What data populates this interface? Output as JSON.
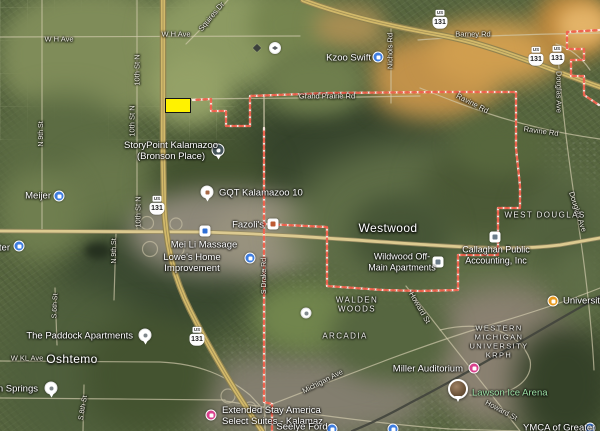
{
  "map": {
    "colors": {
      "boundary": "#EE604B",
      "parcel_fill": "#FFF200",
      "poi_blue": "#3E7DE0",
      "poi_pink": "#D9418D",
      "poi_orange": "#E89A1F",
      "park_text": "#9FE3A8",
      "freeway": "#D2B96A",
      "major_road": "#DCCA90"
    },
    "parcel": {
      "x": 165,
      "y": 98,
      "w": 26,
      "h": 15
    },
    "labels": [
      {
        "n": "road-w-h-ave-1",
        "t": "W H Ave",
        "x": 59,
        "y": 40,
        "fs": 7.5,
        "cls": "road"
      },
      {
        "n": "road-w-h-ave-2",
        "t": "W H Ave",
        "x": 176,
        "y": 35,
        "fs": 7.5,
        "cls": "road"
      },
      {
        "n": "road-squires-dr",
        "t": "Squires Dr",
        "x": 212,
        "y": 17,
        "fs": 7.5,
        "cls": "road",
        "rot": -50
      },
      {
        "n": "road-10th-st-n-1",
        "t": "10th St N",
        "x": 138,
        "y": 70,
        "fs": 7.5,
        "cls": "road",
        "rot": -90
      },
      {
        "n": "road-10th-st-n-2",
        "t": "10th St N",
        "x": 133,
        "y": 121,
        "fs": 7.5,
        "cls": "road",
        "rot": -90
      },
      {
        "n": "road-10th-st-n-3",
        "t": "10th St N",
        "x": 139,
        "y": 212,
        "fs": 7.5,
        "cls": "road",
        "rot": -90
      },
      {
        "n": "road-n-9th-st-1",
        "t": "N 9th St",
        "x": 42,
        "y": 134,
        "fs": 7,
        "cls": "road",
        "rot": -90
      },
      {
        "n": "road-n-9th-st-2",
        "t": "N 9th St",
        "x": 115,
        "y": 251,
        "fs": 7,
        "cls": "road",
        "rot": -90
      },
      {
        "n": "road-s-6th-st",
        "t": "S 6th St",
        "x": 56,
        "y": 306,
        "fs": 7,
        "cls": "road",
        "rot": -87
      },
      {
        "n": "road-s-8th-st",
        "t": "S 8th St",
        "x": 84,
        "y": 408,
        "fs": 7,
        "cls": "road",
        "rot": -80
      },
      {
        "n": "road-w-kl-ave",
        "t": "W KL Ave",
        "x": 27,
        "y": 359,
        "fs": 7.5,
        "cls": "road"
      },
      {
        "n": "road-grand-prairie-rd",
        "t": "Grand Prairie Rd",
        "x": 327,
        "y": 97,
        "fs": 7.5,
        "cls": "road"
      },
      {
        "n": "road-barney-rd",
        "t": "Barney Rd",
        "x": 473,
        "y": 35,
        "fs": 7.5,
        "cls": "road"
      },
      {
        "n": "road-ravine-rd-1",
        "t": "Ravine Rd",
        "x": 472,
        "y": 104,
        "fs": 7.5,
        "cls": "road",
        "rot": 27
      },
      {
        "n": "road-ravine-rd-2",
        "t": "Ravine Rd",
        "x": 541,
        "y": 132,
        "fs": 7.5,
        "cls": "road",
        "rot": 8
      },
      {
        "n": "road-nichols-rd",
        "t": "Nichols Rd",
        "x": 391,
        "y": 51,
        "fs": 7.5,
        "cls": "road",
        "rot": -90
      },
      {
        "n": "road-douglas-ave-1",
        "t": "Douglas Ave",
        "x": 558,
        "y": 92,
        "fs": 7.5,
        "cls": "road",
        "rot": 90
      },
      {
        "n": "road-douglas-ave-2",
        "t": "Douglas Ave",
        "x": 577,
        "y": 212,
        "fs": 7.5,
        "cls": "road",
        "rot": 72
      },
      {
        "n": "road-howard-st-1",
        "t": "Howard St",
        "x": 419,
        "y": 308,
        "fs": 7.5,
        "cls": "road",
        "rot": 60
      },
      {
        "n": "road-howard-st-2",
        "t": "Howard St",
        "x": 501,
        "y": 411,
        "fs": 7.5,
        "cls": "road",
        "rot": 28
      },
      {
        "n": "road-michigan-ave",
        "t": "Michigan Ave",
        "x": 323,
        "y": 382,
        "fs": 7.5,
        "cls": "road",
        "rot": -27
      },
      {
        "n": "road-s-drake-rd",
        "t": "S Drake Rd",
        "x": 265,
        "y": 276,
        "fs": 7,
        "cls": "road",
        "rot": -90
      },
      {
        "n": "place-oshtemo",
        "t": "Oshtemo",
        "x": 72,
        "y": 359,
        "fs": 12,
        "cls": "place"
      },
      {
        "n": "place-westwood",
        "t": "Westwood",
        "x": 388,
        "y": 228,
        "fs": 12,
        "cls": "place"
      },
      {
        "n": "hood-walden-woods",
        "t": "WALDEN\nWOODS",
        "x": 357,
        "y": 305,
        "fs": 8,
        "cls": "hood"
      },
      {
        "n": "hood-arcadia",
        "t": "ARCADIA",
        "x": 345,
        "y": 336,
        "fs": 8,
        "cls": "hood"
      },
      {
        "n": "hood-west-douglas",
        "t": "WEST DOUGLAS",
        "x": 545,
        "y": 215,
        "fs": 8,
        "cls": "hood"
      },
      {
        "n": "hood-western-michigan-university",
        "t": "WESTERN\nMICHIGAN\nUNIVERSITY\nKRPH",
        "x": 499,
        "y": 342,
        "fs": 7.5,
        "cls": "hood"
      },
      {
        "n": "poi-storypoint-kalamazoo",
        "t": "StoryPoint Kalamazoo\n(Bronson Place)",
        "x": 171,
        "y": 151,
        "fs": 9.5,
        "cls": "poi"
      },
      {
        "n": "poi-kzoo-swift",
        "t": "Kzoo Swift",
        "x": 371,
        "y": 58,
        "fs": 9.5,
        "cls": "poi",
        "a": "r"
      },
      {
        "n": "poi-meijer",
        "t": "Meijer",
        "x": 51,
        "y": 196,
        "fs": 9.5,
        "cls": "poi",
        "a": "r"
      },
      {
        "n": "poi-left-edge-cut",
        "t": "ter",
        "x": 10,
        "y": 248,
        "fs": 9.5,
        "cls": "poi",
        "a": "r"
      },
      {
        "n": "poi-gqt-kalamazoo-10",
        "t": "GQT Kalamazoo 10",
        "x": 219,
        "y": 193,
        "fs": 9.5,
        "cls": "poi",
        "a": "l"
      },
      {
        "n": "poi-mei-li-massage",
        "t": "Mei Li Massage",
        "x": 204,
        "y": 245,
        "fs": 9.5,
        "cls": "poi"
      },
      {
        "n": "poi-fazolis",
        "t": "Fazoli's",
        "x": 264,
        "y": 225,
        "fs": 9.5,
        "cls": "poi",
        "a": "r"
      },
      {
        "n": "poi-lowes-home-improvement",
        "t": "Lowe's Home\nImprovement",
        "x": 192,
        "y": 263,
        "fs": 9.5,
        "cls": "poi"
      },
      {
        "n": "poi-wildwood-off-main",
        "t": "Wildwood Off-\nMain Apartments",
        "x": 402,
        "y": 262,
        "fs": 9,
        "cls": "poi"
      },
      {
        "n": "poi-callaghan-accounting",
        "t": "Callaghan Public\nAccounting, Inc",
        "x": 496,
        "y": 255,
        "fs": 9,
        "cls": "poi"
      },
      {
        "n": "poi-paddock-apartments",
        "t": "The Paddock Apartments",
        "x": 133,
        "y": 336,
        "fs": 9.5,
        "cls": "poi",
        "a": "r"
      },
      {
        "n": "poi-tain-springs-cut",
        "t": "tain Springs",
        "x": 38,
        "y": 389,
        "fs": 9.5,
        "cls": "poi",
        "a": "r"
      },
      {
        "n": "poi-miller-auditorium",
        "t": "Miller Auditorium",
        "x": 463,
        "y": 369,
        "fs": 9.5,
        "cls": "poi",
        "a": "r"
      },
      {
        "n": "poi-lawson-ice-arena",
        "t": "Lawson Ice Arena",
        "x": 472,
        "y": 393,
        "fs": 9.5,
        "cls": "park",
        "a": "l"
      },
      {
        "n": "poi-university-cut",
        "t": "University Ro",
        "x": 563,
        "y": 301,
        "fs": 9.5,
        "cls": "poi",
        "a": "l"
      },
      {
        "n": "poi-extended-stay-america",
        "t": "Extended Stay America\nSelect Suites - Kalamaz",
        "x": 222,
        "y": 416,
        "fs": 9.5,
        "cls": "poi",
        "a": "l"
      },
      {
        "n": "poi-seelye-ford",
        "t": "Seelye Ford",
        "x": 302,
        "y": 427,
        "fs": 9.5,
        "cls": "poi"
      },
      {
        "n": "poi-ymca",
        "t": "YMCA of Greater",
        "x": 523,
        "y": 428,
        "fs": 9.5,
        "cls": "poi",
        "a": "l"
      }
    ],
    "icons": [
      {
        "k": "pin-dark",
        "x": 218,
        "y": 150,
        "n": "storypoint-pin-icon"
      },
      {
        "k": "cb",
        "x": 378,
        "y": 57,
        "n": "kzoo-swift-shopping-icon"
      },
      {
        "k": "cb",
        "x": 59,
        "y": 196,
        "n": "meijer-shopping-icon"
      },
      {
        "k": "cb",
        "x": 19,
        "y": 246,
        "n": "left-edge-poi-icon"
      },
      {
        "k": "pin-movie",
        "x": 207,
        "y": 192,
        "n": "gqt-theater-pin-icon"
      },
      {
        "k": "sq-blue",
        "x": 205,
        "y": 231,
        "n": "mei-li-massage-icon"
      },
      {
        "k": "sq-red",
        "x": 273,
        "y": 224,
        "n": "fazolis-restaurant-icon"
      },
      {
        "k": "cb",
        "x": 250,
        "y": 258,
        "n": "lowes-shopping-icon"
      },
      {
        "k": "sq-gray",
        "x": 438,
        "y": 262,
        "n": "wildwood-apartments-icon"
      },
      {
        "k": "sq-gray",
        "x": 495,
        "y": 237,
        "n": "callaghan-office-icon"
      },
      {
        "k": "pin-white",
        "x": 145,
        "y": 335,
        "n": "paddock-pin-icon"
      },
      {
        "k": "pin-white",
        "x": 51,
        "y": 388,
        "n": "springs-pin-icon"
      },
      {
        "k": "cpk",
        "x": 474,
        "y": 368,
        "n": "miller-auditorium-arts-icon"
      },
      {
        "k": "photo-pin",
        "x": 458,
        "y": 389,
        "n": "lawson-photo-pin-icon"
      },
      {
        "k": "cor",
        "x": 553,
        "y": 301,
        "n": "university-restaurant-icon"
      },
      {
        "k": "cpk",
        "x": 211,
        "y": 415,
        "n": "extended-stay-hotel-icon"
      },
      {
        "k": "cb",
        "x": 332,
        "y": 429,
        "n": "seelye-ford-icon"
      },
      {
        "k": "cb",
        "x": 590,
        "y": 428,
        "n": "ymca-icon"
      },
      {
        "k": "school",
        "x": 275,
        "y": 48,
        "n": "school-icon"
      },
      {
        "k": "mini-dark",
        "x": 257,
        "y": 48,
        "n": "small-poi-icon"
      },
      {
        "k": "cw",
        "x": 306,
        "y": 313,
        "n": "generic-poi-icon"
      },
      {
        "k": "cb",
        "x": 393,
        "y": 429,
        "n": "bottom-edge-poi-icon"
      }
    ],
    "shields": [
      {
        "top": "US",
        "num": "131",
        "x": 440,
        "y": 19,
        "n": "us-131-shield-1"
      },
      {
        "top": "US",
        "num": "131",
        "x": 536,
        "y": 56,
        "n": "us-131-shield-2"
      },
      {
        "top": "US",
        "num": "131",
        "x": 557,
        "y": 55,
        "n": "us-131-shield-3"
      },
      {
        "top": "US",
        "num": "131",
        "x": 157,
        "y": 205,
        "n": "us-131-shield-4"
      },
      {
        "top": "US",
        "num": "131",
        "x": 197,
        "y": 336,
        "n": "us-131-shield-5"
      }
    ]
  }
}
